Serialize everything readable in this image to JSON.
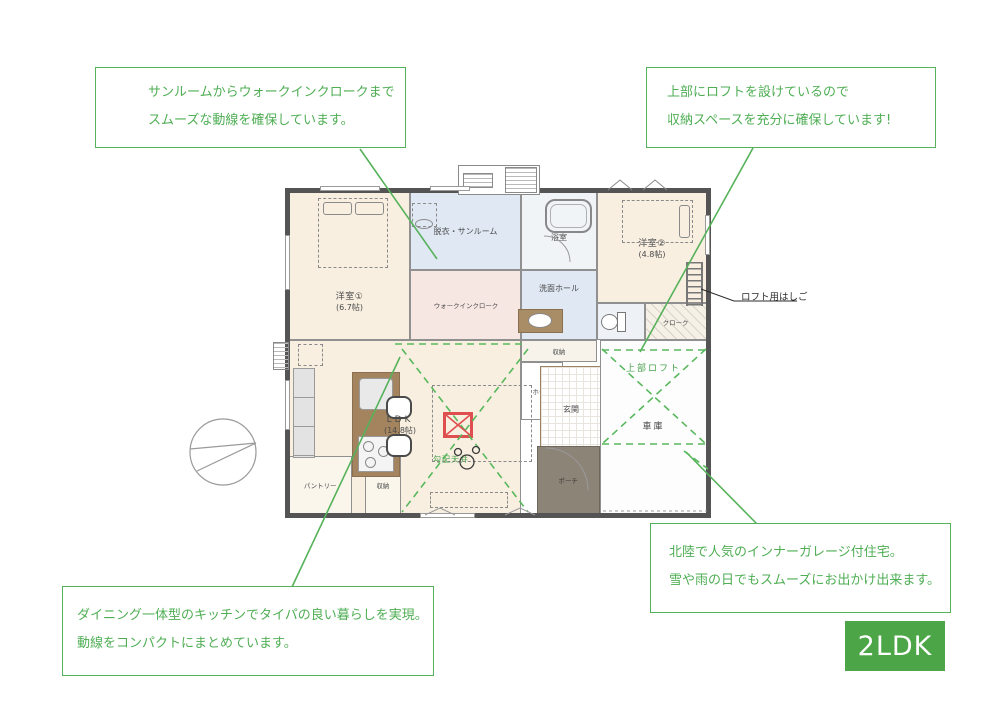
{
  "badge": {
    "label": "2LDK",
    "bg": "#4ca647"
  },
  "colors": {
    "accent_green": "#56b25a",
    "badge_green": "#4ca647",
    "stove_red": "#e04f4f",
    "room_cream": "#f8efe1",
    "room_blue": "#dfe8f3",
    "room_pink": "#f7e7e3",
    "porch_brown": "#8d8478",
    "counter_brown": "#a3845e"
  },
  "callouts": {
    "sunroom": {
      "line1": "サンルームからウォークインクロークまで",
      "line2": "スムーズな動線を確保しています。"
    },
    "loft": {
      "line1": "上部にロフトを設けているので",
      "line2": "収納スペースを充分に確保しています!"
    },
    "garage": {
      "line1": "北陸で人気のインナーガレージ付住宅。",
      "line2": "雪や雨の日でもスムーズにお出かけ出来ます。"
    },
    "kitchen": {
      "line1": "ダイニング一体型のキッチンでタイパの良い暮らしを実現。",
      "line2": "動線をコンパクトにまとめています。"
    }
  },
  "rooms": {
    "bedroom1": {
      "name": "洋室①",
      "size": "(6.7帖)"
    },
    "bedroom2": {
      "name": "洋室②",
      "size": "(4.8帖)"
    },
    "sunroom": "脱衣・サンルーム",
    "bathroom": "浴室",
    "wash_hall": "洗面ホール",
    "wic": "ウォークインクローク",
    "wc": "WC",
    "cloak": "クローク",
    "storage_mid": "収納",
    "hall": "ホール",
    "entrance": "玄関",
    "garage": "車庫",
    "upper_loft": "上部ロフト",
    "ldk": {
      "name": "LDK",
      "size": "(14.8帖)"
    },
    "sloped_ceiling": "勾配天井",
    "pantry": "パントリー",
    "storage_small": "収納",
    "porch": "ポーチ",
    "ladder_label": "ロフト用はしご"
  }
}
